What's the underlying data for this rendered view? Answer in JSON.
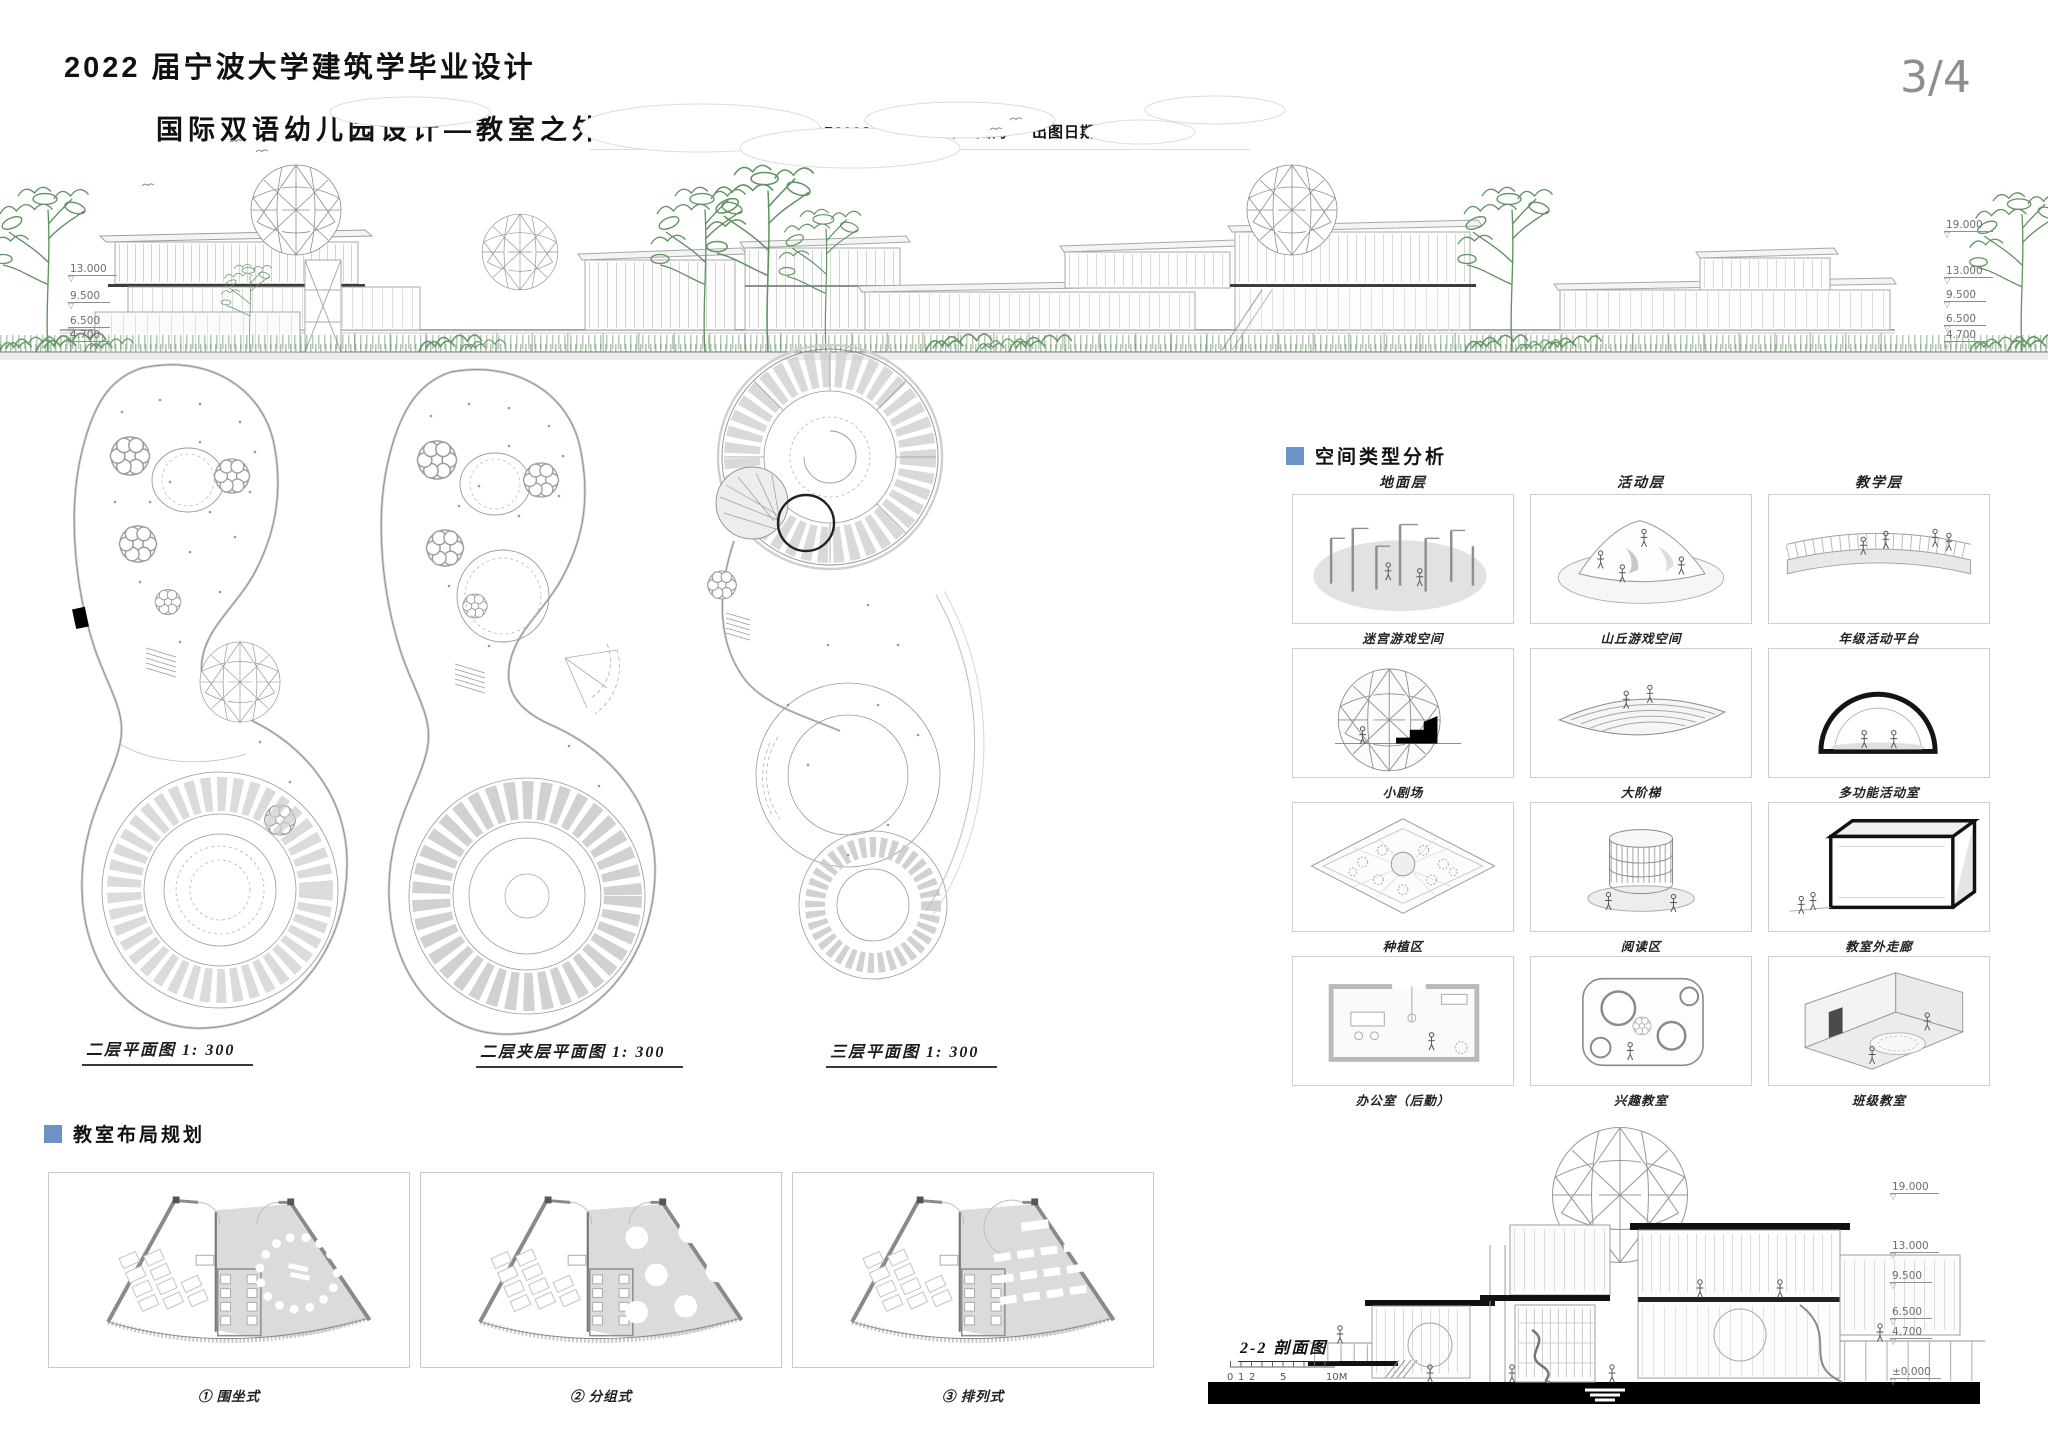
{
  "page": {
    "number": "3/4"
  },
  "header": {
    "title": "2022 届宁波大学建筑学毕业设计",
    "subtitle": "国际双语幼儿园设计—教室之外的重要性",
    "student": "王倩颖 176002485",
    "advisor": "导师：陆海",
    "date": "出图日期：2022.5.6"
  },
  "markers": {
    "level": "▽"
  },
  "elevation": {
    "left_levels": [
      "13.000",
      "9.500",
      "6.500",
      "4.700"
    ],
    "right_levels": [
      "19.000",
      "13.000",
      "9.500",
      "6.500",
      "4.700"
    ]
  },
  "plans": [
    {
      "caption": "二层平面图 1: 300"
    },
    {
      "caption": "二层夹层平面图 1: 300"
    },
    {
      "caption": "三层平面图 1: 300"
    }
  ],
  "space_analysis": {
    "title": "空间类型分析",
    "columns": [
      "地面层",
      "活动层",
      "教学层"
    ],
    "cells": [
      [
        "迷宫游戏空间",
        "山丘游戏空间",
        "年级活动平台"
      ],
      [
        "小剧场",
        "大阶梯",
        "多功能活动室"
      ],
      [
        "种植区",
        "阅读区",
        "教室外走廊"
      ],
      [
        "办公室（后勤）",
        "兴趣教室",
        "班级教室"
      ]
    ],
    "icons": [
      [
        "maze-play-icon",
        "hill-play-icon",
        "grade-activity-platform-icon"
      ],
      [
        "small-theater-icon",
        "grand-stair-icon",
        "multifunction-room-icon"
      ],
      [
        "planting-area-icon",
        "reading-area-icon",
        "classroom-corridor-icon"
      ],
      [
        "office-icon",
        "interest-classroom-icon",
        "class-classroom-icon"
      ]
    ]
  },
  "classroom_layout": {
    "title": "教室布局规划",
    "items": [
      "① 围坐式",
      "② 分组式",
      "③ 排列式"
    ]
  },
  "section": {
    "caption": "2-2 剖面图",
    "scale_ticks": [
      "0",
      "1",
      "2",
      "5",
      "10M"
    ],
    "levels": [
      "19.000",
      "13.000",
      "9.500",
      "6.500",
      "4.700",
      "±0.000"
    ]
  },
  "colors": {
    "accent_blue": "#6d92c6",
    "tree_green": "#5f935f",
    "line_gray": "#a8a8a8",
    "slab_black": "#141414"
  }
}
